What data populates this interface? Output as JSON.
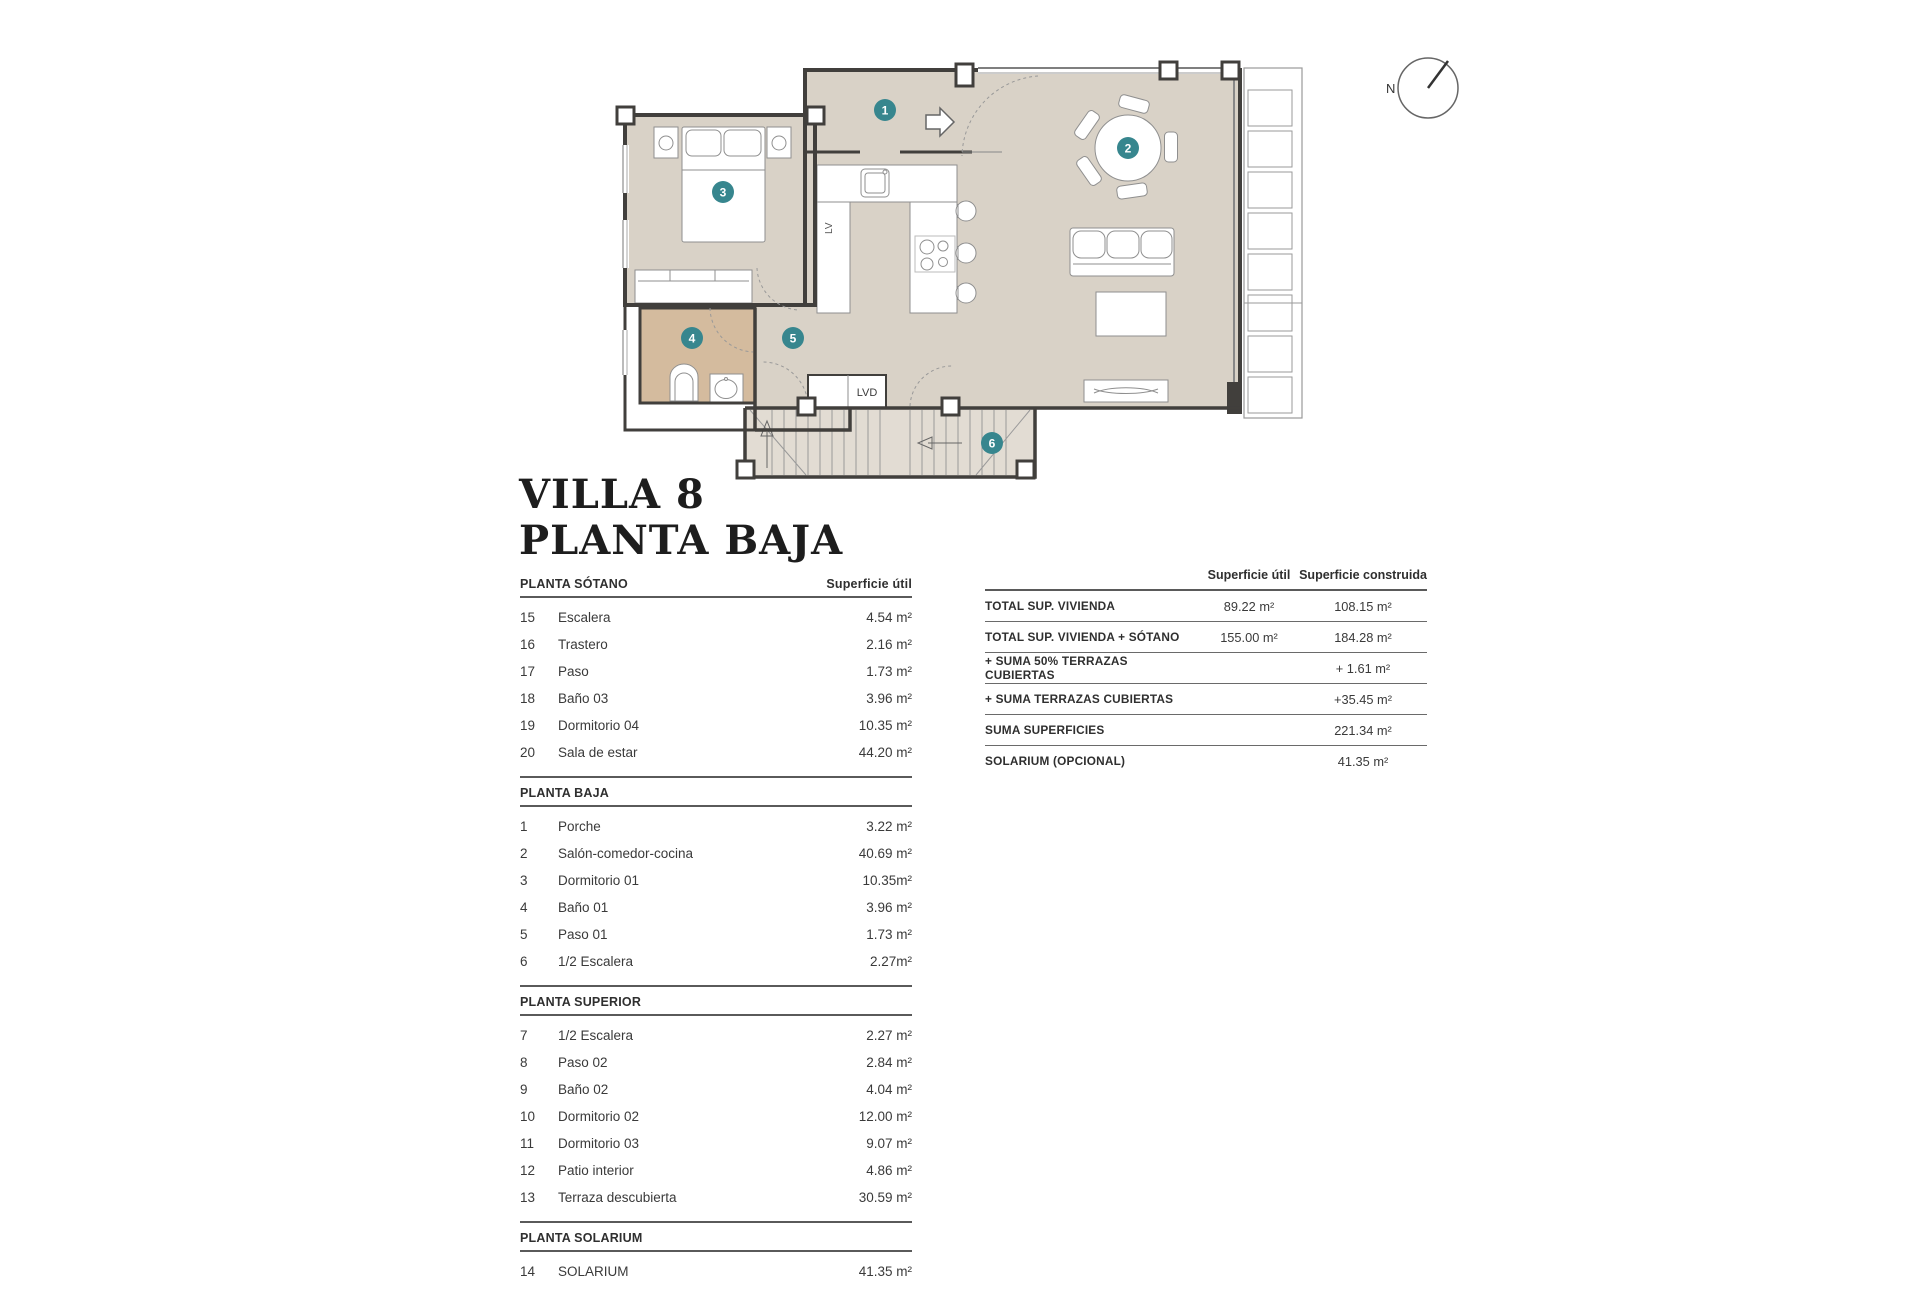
{
  "title": {
    "line1": "VILLA 8",
    "line2": "PLANTA BAJA"
  },
  "plan": {
    "labels": {
      "compass": "N",
      "dishwasher": "LV",
      "laundry": "LVD"
    },
    "colors": {
      "badge": "#37868e",
      "floor": "#d9d2c7",
      "bath_floor": "#d4bb9e",
      "stairs_floor": "#e2dcd3",
      "wall": "#413f3c"
    },
    "room_badges": [
      {
        "number": "1",
        "room": "Porche",
        "x": 275,
        "y": 80
      },
      {
        "number": "2",
        "room": "Salón-comedor-cocina",
        "x": 518,
        "y": 118
      },
      {
        "number": "3",
        "room": "Dormitorio 01",
        "x": 113,
        "y": 162
      },
      {
        "number": "4",
        "room": "Baño 01",
        "x": 82,
        "y": 308
      },
      {
        "number": "5",
        "room": "Paso 01",
        "x": 183,
        "y": 308
      },
      {
        "number": "6",
        "room": "1/2 Escalera",
        "x": 382,
        "y": 413
      }
    ]
  },
  "left_table": {
    "value_header": "Superficie útil",
    "sections": [
      {
        "name": "PLANTA SÓTANO",
        "rows": [
          [
            "15",
            "Escalera",
            "4.54 m²"
          ],
          [
            "16",
            "Trastero",
            "2.16 m²"
          ],
          [
            "17",
            "Paso",
            "1.73 m²"
          ],
          [
            "18",
            "Baño 03",
            "3.96 m²"
          ],
          [
            "19",
            "Dormitorio 04",
            "10.35 m²"
          ],
          [
            "20",
            "Sala de estar",
            "44.20 m²"
          ]
        ]
      },
      {
        "name": "PLANTA BAJA",
        "rows": [
          [
            "1",
            "Porche",
            "3.22 m²"
          ],
          [
            "2",
            "Salón-comedor-cocina",
            "40.69 m²"
          ],
          [
            "3",
            "Dormitorio 01",
            "10.35m²"
          ],
          [
            "4",
            "Baño 01",
            "3.96 m²"
          ],
          [
            "5",
            "Paso 01",
            "1.73 m²"
          ],
          [
            "6",
            "1/2 Escalera",
            "2.27m²"
          ]
        ]
      },
      {
        "name": "PLANTA SUPERIOR",
        "rows": [
          [
            "7",
            "1/2 Escalera",
            "2.27 m²"
          ],
          [
            "8",
            "Paso 02",
            "2.84 m²"
          ],
          [
            "9",
            "Baño 02",
            "4.04 m²"
          ],
          [
            "10",
            "Dormitorio 02",
            "12.00 m²"
          ],
          [
            "11",
            "Dormitorio 03",
            "9.07 m²"
          ],
          [
            "12",
            "Patio interior",
            "4.86 m²"
          ],
          [
            "13",
            "Terraza descubierta",
            "30.59 m²"
          ]
        ]
      },
      {
        "name": "PLANTA SOLARIUM",
        "rows": [
          [
            "14",
            "SOLARIUM",
            "41.35 m²"
          ]
        ]
      }
    ]
  },
  "right_table": {
    "col1": "Superficie útil",
    "col2": "Superficie construida",
    "rows": [
      {
        "label": "TOTAL SUP. VIVIENDA",
        "util": "89.22 m²",
        "constr": "108.15 m²"
      },
      {
        "label": "TOTAL SUP. VIVIENDA + SÓTANO",
        "util": "155.00 m²",
        "constr": "184.28 m²"
      },
      {
        "label": "+ SUMA 50% TERRAZAS CUBIERTAS",
        "util": "",
        "constr": "+ 1.61 m²"
      },
      {
        "label": "+ SUMA TERRAZAS CUBIERTAS",
        "util": "",
        "constr": "+35.45 m²"
      },
      {
        "label": "SUMA SUPERFICIES",
        "util": "",
        "constr": "221.34 m²"
      },
      {
        "label": "SOLARIUM (OPCIONAL)",
        "util": "",
        "constr": "41.35 m²"
      }
    ]
  }
}
